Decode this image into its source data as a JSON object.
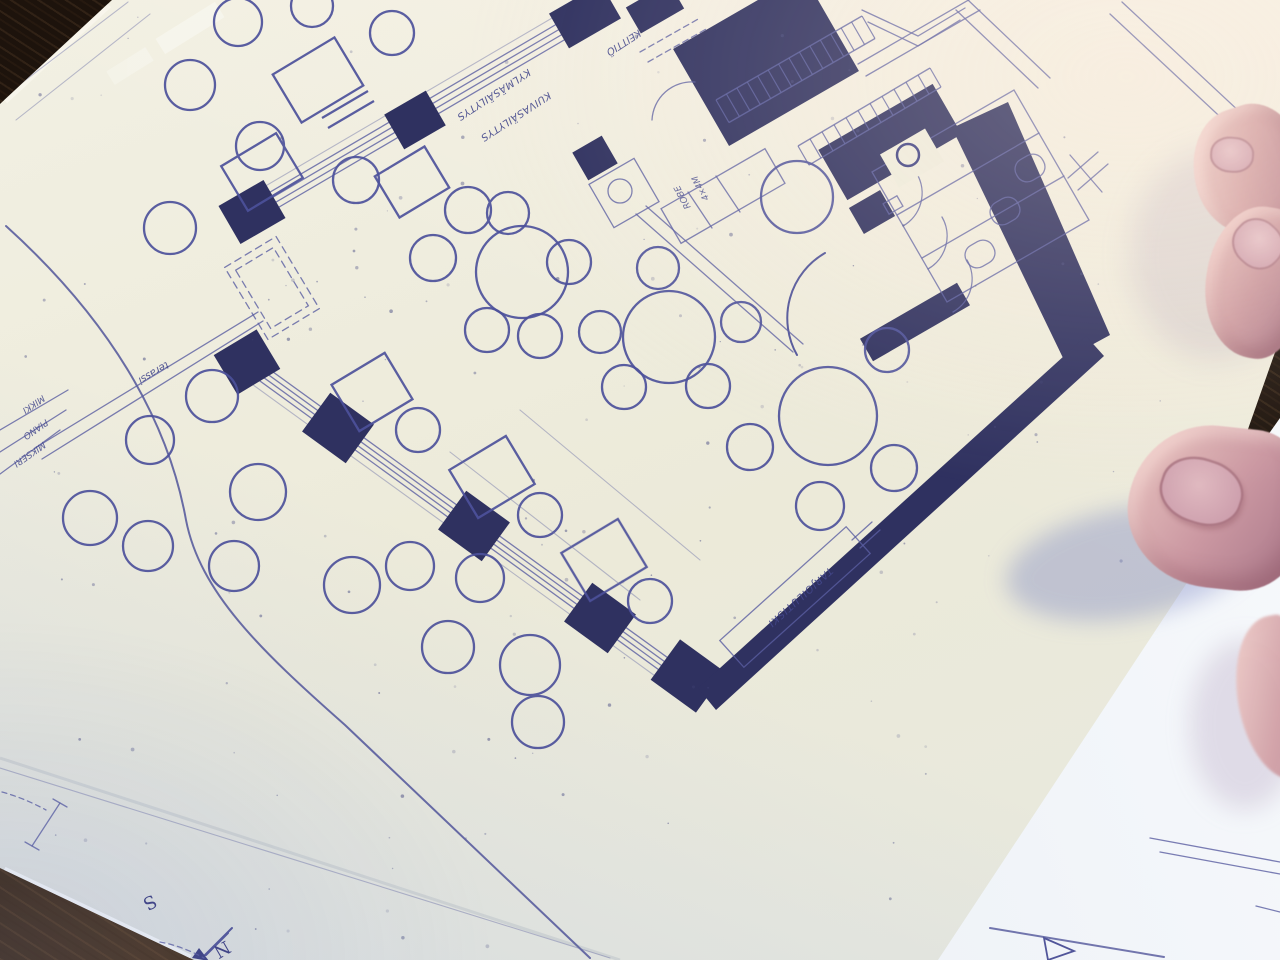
{
  "scene": {
    "type": "photograph",
    "subject": "restaurant floor-plan blueprint on a wooden table, held at the right edge by two fingertips and a thumb, with a second drawing sheet underneath",
    "plan_features": [
      "dining-room-round-tables",
      "square-tables",
      "window-wall-with-piers",
      "entrance-vestibule",
      "kitchen",
      "storage-racks",
      "wc-stalls",
      "serving-counter",
      "terrace-seating",
      "north-arrow"
    ]
  },
  "labels": {
    "storage_note_1": "KYLMÄSÄILYTYS",
    "storage_note_2": "KUIVASÄILYTYS",
    "kitchen_note": "KEITTIÖ",
    "rack_note_1": "4×4M",
    "rack_note_2": "ROBE",
    "counter_note": "TARJOILUTISKI",
    "stage_note": "terassi",
    "margin_notes": [
      "MIKKI",
      "PIANO",
      "MIKSERI"
    ],
    "compass_south": "S",
    "compass_north": "N"
  },
  "palette": {
    "paper": "#edebdc",
    "ink_line": "#51559a",
    "ink_wall": "#2f3160",
    "under_sheet": "#f3f5f9",
    "wood": "#26190f",
    "skin": "#c9959e",
    "nail": "#d6abb6"
  }
}
